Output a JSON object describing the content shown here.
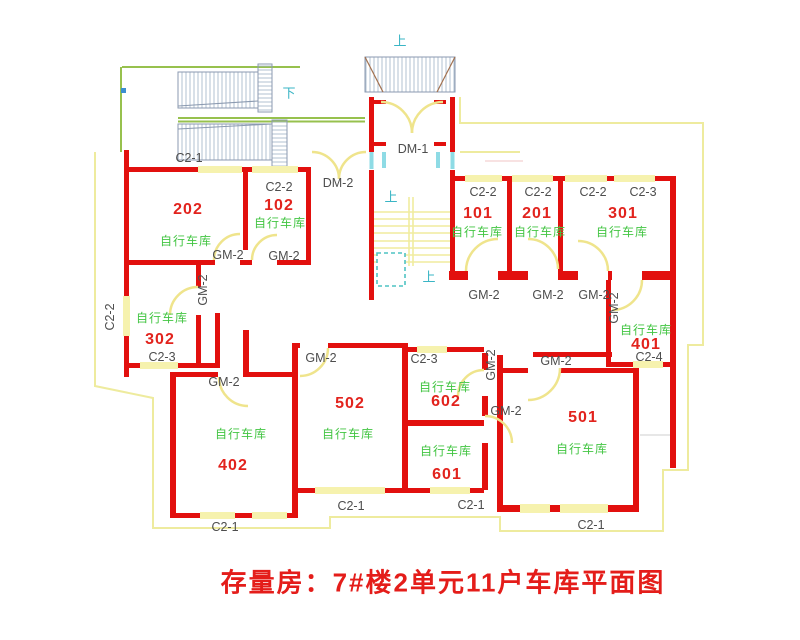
{
  "title": {
    "text": "存量房：7#楼2单元11户车库平面图"
  },
  "colors": {
    "wall_red": "#e2100e",
    "room_number_red": "#e2231d",
    "garage_green": "#43c543",
    "annotation_gray": "#4d4d4d",
    "direction_teal": "#3ab5c5",
    "boundary_yellow": "#eeeb9e",
    "window_fill_yellow": "#f6f2ae",
    "door_arc_yellow": "#efe48c",
    "ramp_green": "#97c14e",
    "title_red": "#e41d1a"
  },
  "plan": {
    "direction_labels": [
      {
        "text": "上",
        "x": 400,
        "y": 41
      },
      {
        "text": "下",
        "x": 289,
        "y": 93
      },
      {
        "text": "上",
        "x": 391,
        "y": 197
      },
      {
        "text": "上",
        "x": 429,
        "y": 277
      }
    ],
    "room_numbers": [
      {
        "text": "202",
        "x": 188,
        "y": 210
      },
      {
        "text": "102",
        "x": 279,
        "y": 206
      },
      {
        "text": "101",
        "x": 478,
        "y": 214
      },
      {
        "text": "201",
        "x": 537,
        "y": 214
      },
      {
        "text": "301",
        "x": 623,
        "y": 214
      },
      {
        "text": "302",
        "x": 160,
        "y": 340
      },
      {
        "text": "401",
        "x": 646,
        "y": 345
      },
      {
        "text": "402",
        "x": 233,
        "y": 466
      },
      {
        "text": "502",
        "x": 350,
        "y": 404
      },
      {
        "text": "602",
        "x": 446,
        "y": 402
      },
      {
        "text": "601",
        "x": 447,
        "y": 475
      },
      {
        "text": "501",
        "x": 583,
        "y": 418
      }
    ],
    "garage_labels": [
      {
        "text": "自行车库",
        "x": 186,
        "y": 241
      },
      {
        "text": "自行车库",
        "x": 280,
        "y": 223
      },
      {
        "text": "自行车库",
        "x": 477,
        "y": 232
      },
      {
        "text": "自行车库",
        "x": 540,
        "y": 232
      },
      {
        "text": "自行车库",
        "x": 622,
        "y": 232
      },
      {
        "text": "自行车库",
        "x": 162,
        "y": 318
      },
      {
        "text": "自行车库",
        "x": 646,
        "y": 330
      },
      {
        "text": "自行车库",
        "x": 241,
        "y": 434
      },
      {
        "text": "自行车库",
        "x": 348,
        "y": 434
      },
      {
        "text": "自行车库",
        "x": 445,
        "y": 387
      },
      {
        "text": "自行车库",
        "x": 446,
        "y": 451
      },
      {
        "text": "自行车库",
        "x": 582,
        "y": 449
      }
    ],
    "window_labels": [
      {
        "text": "C2-1",
        "x": 189,
        "y": 158
      },
      {
        "text": "C2-2",
        "x": 279,
        "y": 187
      },
      {
        "text": "C2-2",
        "x": 483,
        "y": 192
      },
      {
        "text": "C2-2",
        "x": 538,
        "y": 192
      },
      {
        "text": "C2-2",
        "x": 593,
        "y": 192
      },
      {
        "text": "C2-3",
        "x": 643,
        "y": 192
      },
      {
        "text": "C2-2",
        "x": 110,
        "y": 317,
        "rot": -90
      },
      {
        "text": "C2-3",
        "x": 162,
        "y": 357
      },
      {
        "text": "C2-3",
        "x": 424,
        "y": 359
      },
      {
        "text": "C2-4",
        "x": 649,
        "y": 357
      },
      {
        "text": "C2-1",
        "x": 225,
        "y": 527
      },
      {
        "text": "C2-1",
        "x": 351,
        "y": 506
      },
      {
        "text": "C2-1",
        "x": 471,
        "y": 505
      },
      {
        "text": "C2-1",
        "x": 591,
        "y": 525
      }
    ],
    "door_labels": [
      {
        "text": "DM-1",
        "x": 413,
        "y": 149
      },
      {
        "text": "DM-2",
        "x": 338,
        "y": 183
      },
      {
        "text": "GM-2",
        "x": 228,
        "y": 255
      },
      {
        "text": "GM-2",
        "x": 284,
        "y": 256
      },
      {
        "text": "GM-2",
        "x": 203,
        "y": 290,
        "rot": -90
      },
      {
        "text": "GM-2",
        "x": 484,
        "y": 295
      },
      {
        "text": "GM-2",
        "x": 548,
        "y": 295
      },
      {
        "text": "GM-2",
        "x": 594,
        "y": 295
      },
      {
        "text": "GM-2",
        "x": 614,
        "y": 308,
        "rot": -90
      },
      {
        "text": "GM-2",
        "x": 321,
        "y": 358
      },
      {
        "text": "GM-2",
        "x": 556,
        "y": 361
      },
      {
        "text": "GM-2",
        "x": 491,
        "y": 365,
        "rot": -90
      },
      {
        "text": "GM-2",
        "x": 224,
        "y": 382
      },
      {
        "text": "GM-2",
        "x": 506,
        "y": 411
      }
    ]
  }
}
